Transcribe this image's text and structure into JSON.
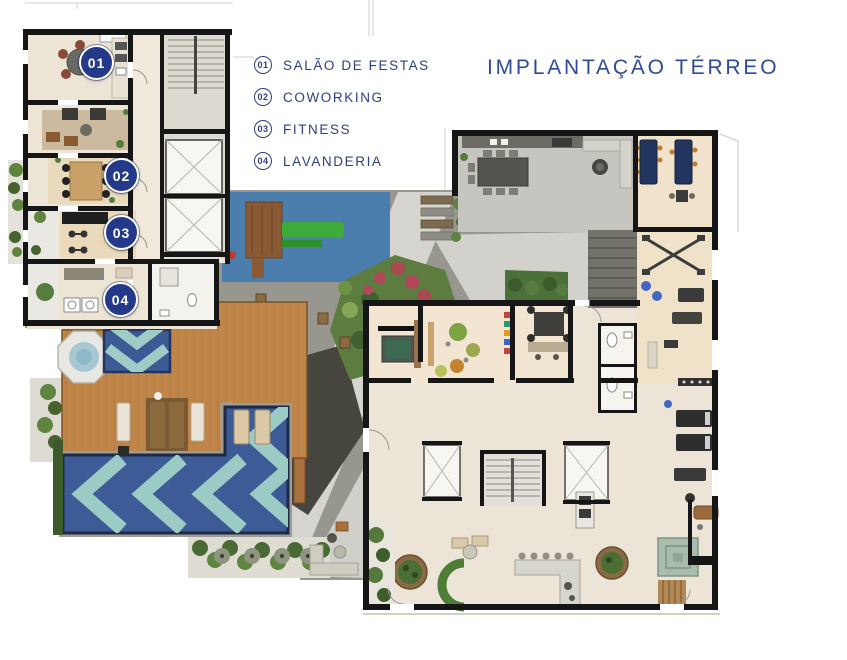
{
  "header": {
    "title": "IMPLANTAÇÃO TÉRREO"
  },
  "legend": {
    "items": [
      {
        "number": "01",
        "label": "SALÃO DE FESTAS"
      },
      {
        "number": "02",
        "label": "COWORKING"
      },
      {
        "number": "03",
        "label": "FITNESS"
      },
      {
        "number": "04",
        "label": "LAVANDERIA"
      }
    ]
  },
  "plan": {
    "badges": [
      {
        "number": "01"
      },
      {
        "number": "02"
      },
      {
        "number": "03"
      },
      {
        "number": "04"
      }
    ]
  },
  "colors": {
    "accent_navy": "#2c3e86",
    "badge_navy": "#24398a",
    "pool_navy": "#3d5c97",
    "pool_aqua": "#9ccbc5",
    "deck_wood": "#c08548",
    "paving_gray": "#98978f",
    "paving_dark": "#46453e",
    "playground_blue": "#4b7ead",
    "floor_beige": "#ece4d5",
    "wall_black": "#161616",
    "garden_green": "#5d7c3f",
    "flower_red": "#a84a52"
  }
}
